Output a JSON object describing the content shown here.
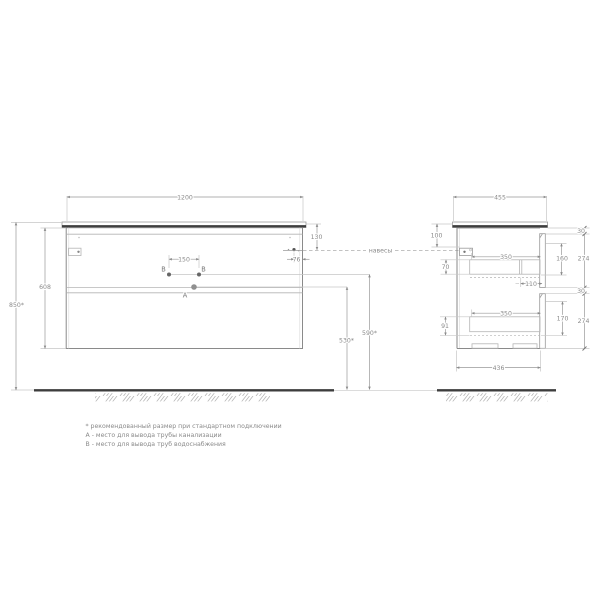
{
  "front": {
    "dims": {
      "width": "1200",
      "body_height": "608",
      "total_height": "850*",
      "top_gap": "130",
      "hinge_inset": "76",
      "pipe_spacing": "150",
      "sewer_height": "530*",
      "water_height": "590*"
    },
    "labels": {
      "a": "A",
      "b_left": "B",
      "b_right": "B"
    }
  },
  "side": {
    "dims": {
      "depth": "455",
      "mount_offset": "100",
      "box1_side": "70",
      "box2_side": "91",
      "box1_len": "350",
      "box2_len": "350",
      "back_offset": "110",
      "box1_depth": "160",
      "box2_depth": "170",
      "front1_height": "274",
      "front2_height": "274",
      "gap_top": "30",
      "gap_mid": "30",
      "base_depth": "436"
    }
  },
  "annotations": {
    "hangers": "навесы"
  },
  "notes": [
    "* рекомендованный размер при стандартном подключении",
    "А - место для вывода трубы канализации",
    "В - место для вывода труб водоснабжения"
  ],
  "colors": {
    "line": "#9a9a9a",
    "dark_edge": "#3d3d3d",
    "dim_text": "#8a8a8a"
  }
}
